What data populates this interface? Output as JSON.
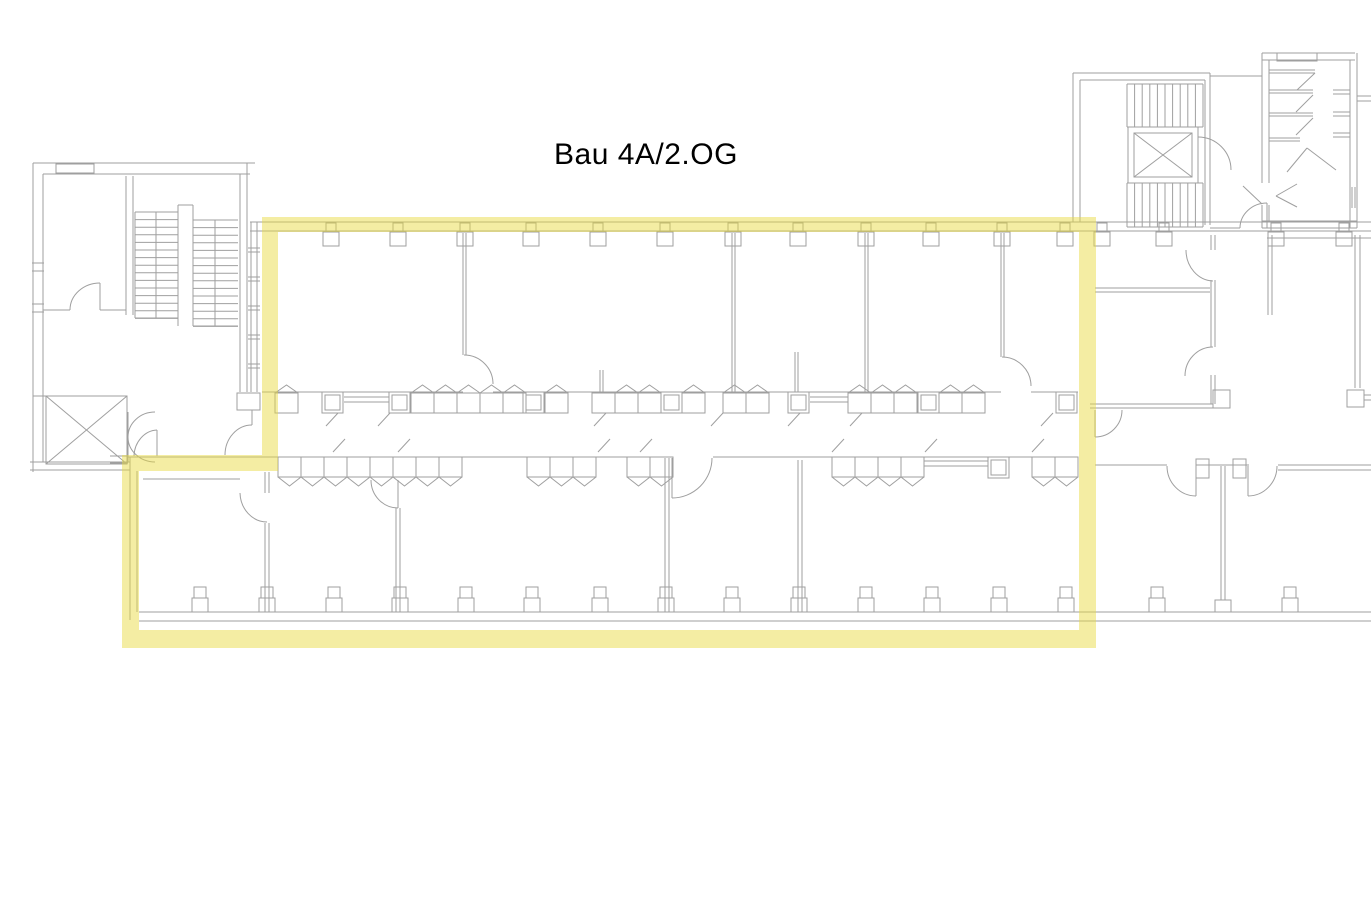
{
  "title": "Bau 4A/2.OG",
  "highlight": {
    "label": "selected-floor-area",
    "color": "#e9d93e",
    "opacity": 0.48
  },
  "plan": {
    "line_color": "#9f9f9f",
    "background": "#ffffff",
    "title_color": "#000000"
  }
}
